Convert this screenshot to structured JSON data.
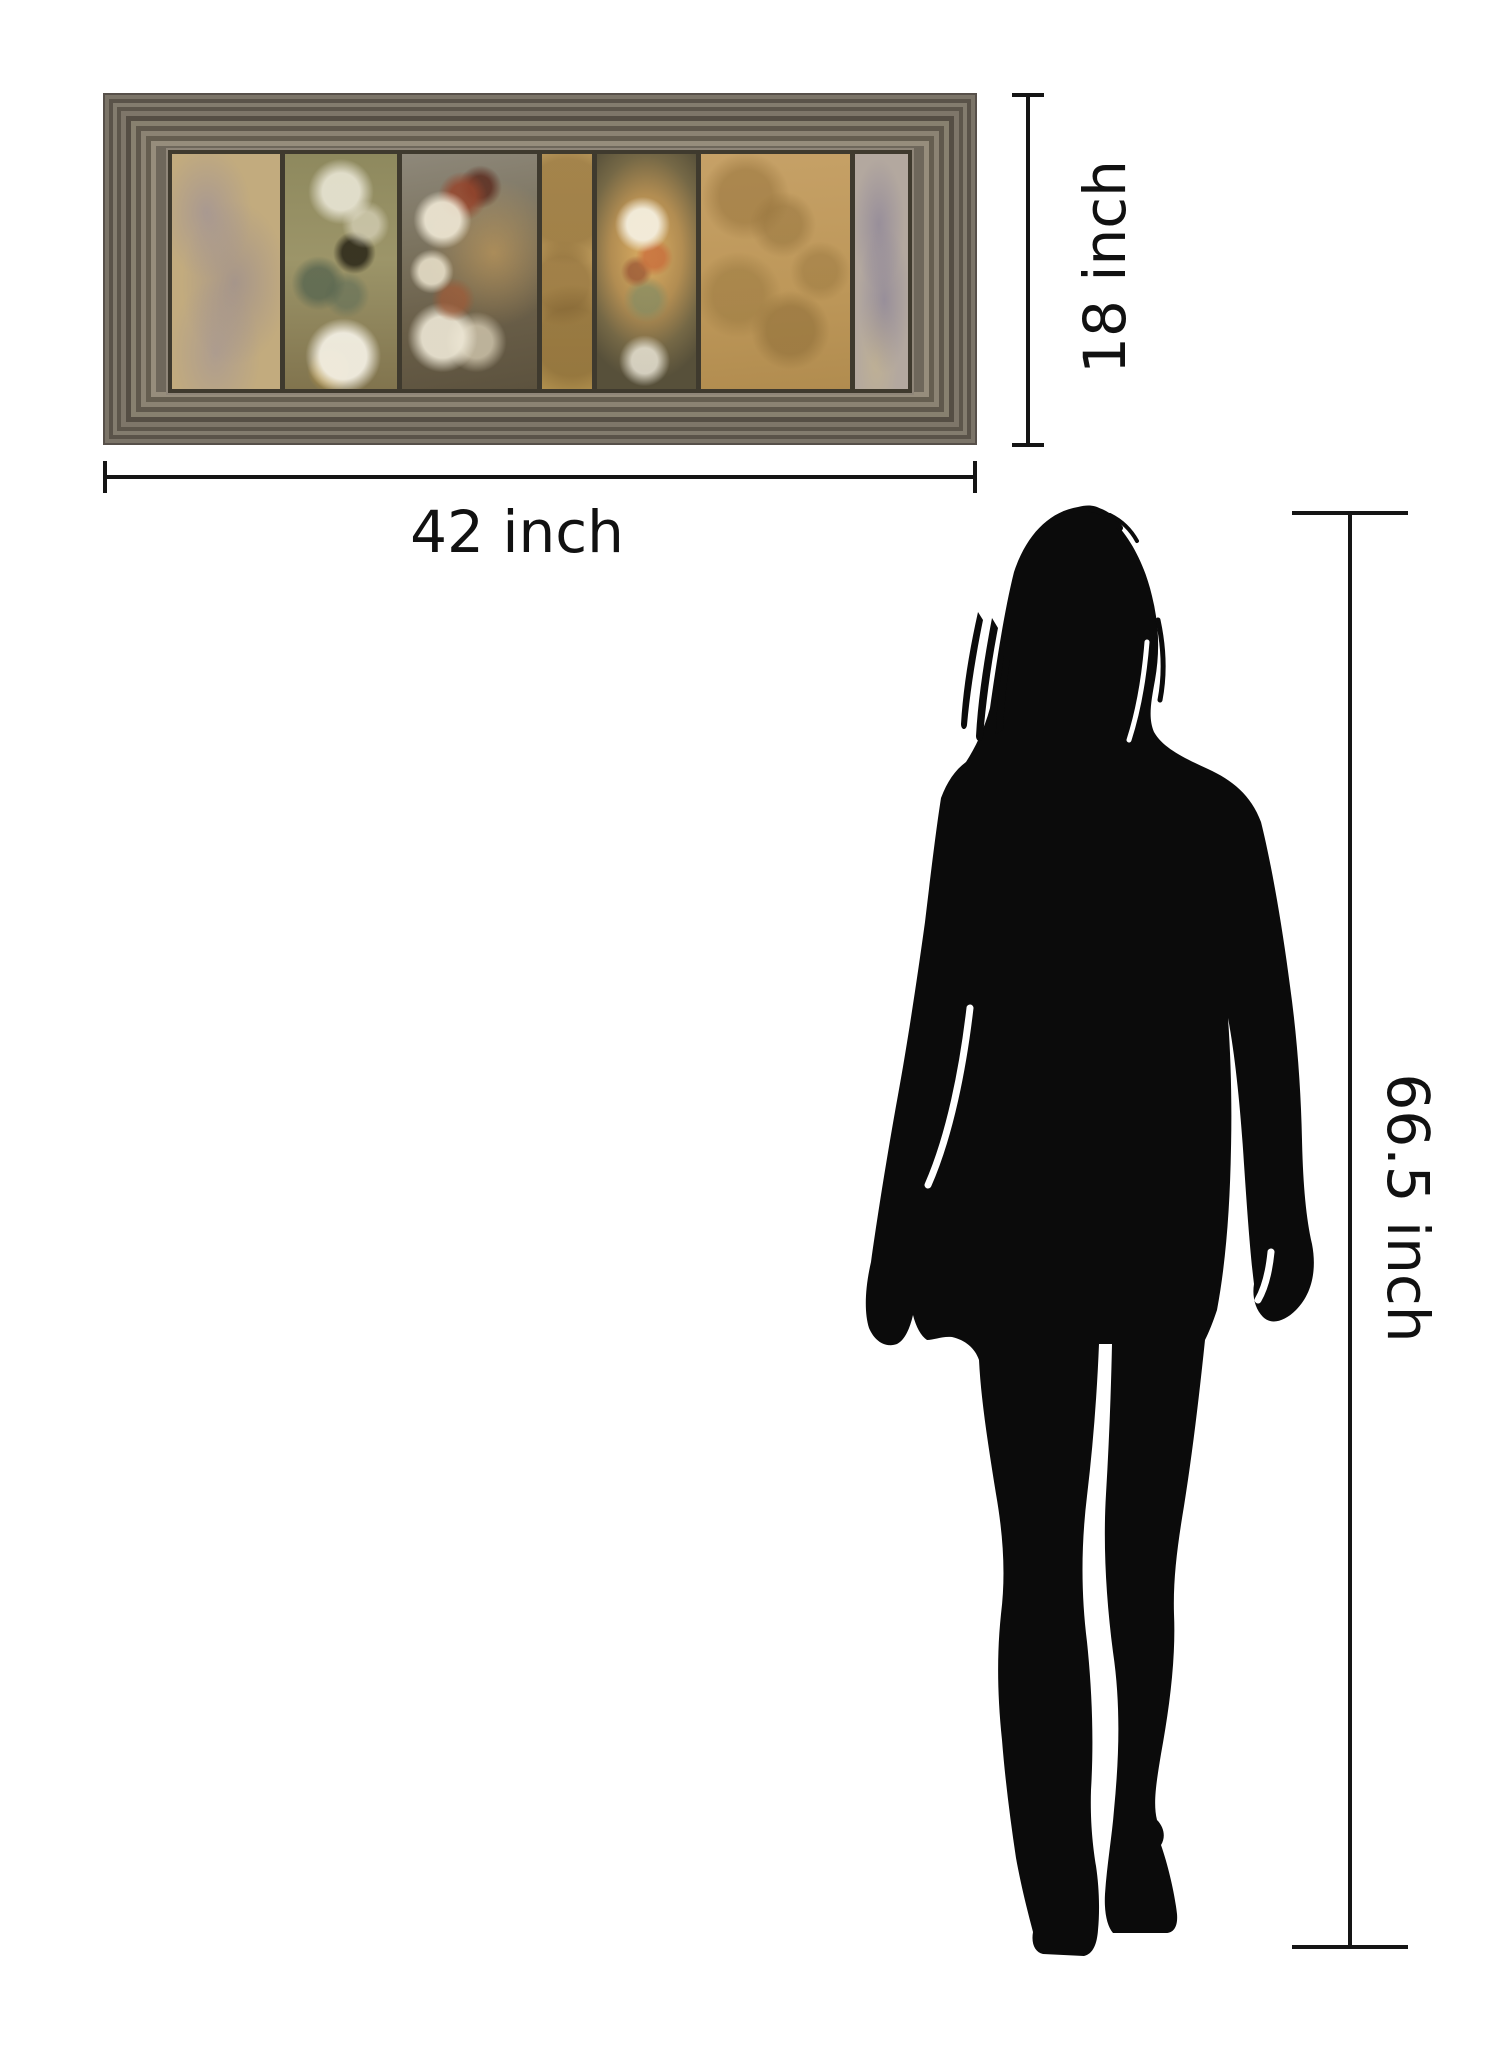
{
  "scene": {
    "background": "#ffffff",
    "description": "Product size comparison diagram: framed wall art with dimension lines next to a human silhouette for scale"
  },
  "artwork": {
    "name": "framed floral panel wall art",
    "frame_color": "#6e675b",
    "backing_color": "#3f3a2e",
    "panel_count": 7,
    "panel_palette": [
      "#c2ab7e",
      "#9c9569",
      "#7c7460",
      "#bf9c5c",
      "#dcae63",
      "#bd9759",
      "#b3a89f"
    ]
  },
  "dimensions": {
    "width": {
      "label": "42 inch"
    },
    "height": {
      "label": "18 inch"
    },
    "person_height": {
      "label": "66.5 inch"
    },
    "line_color": "#151515",
    "text_color": "#111111"
  },
  "person": {
    "name": "woman silhouette",
    "color": "#0b0b0b"
  }
}
